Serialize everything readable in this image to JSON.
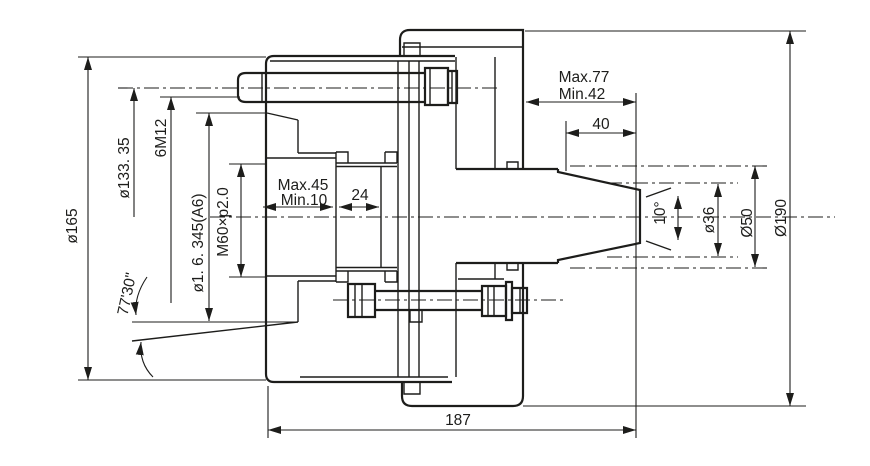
{
  "drawing": {
    "title": "collet-chuck-section-technical-drawing",
    "background": "#ffffff",
    "line_color": "#1d1d1b",
    "labels": {
      "dia165": "ø165",
      "dia133": "ø133. 35",
      "bolt_spec": "6M12",
      "taper_dia": "ø1. 6. 345(A6)",
      "thread": "M60×p2.0",
      "stroke_max": "Max.45",
      "stroke_min": "Min.10",
      "len24": "24",
      "proj_max": "Max.77",
      "proj_min": "Min.42",
      "len40": "40",
      "angle10": "10°",
      "dia36": "ø36",
      "dia50": "Ø50",
      "dia190": "Ø190",
      "taper_angle": "77'30\"",
      "overall_len": "187"
    }
  }
}
